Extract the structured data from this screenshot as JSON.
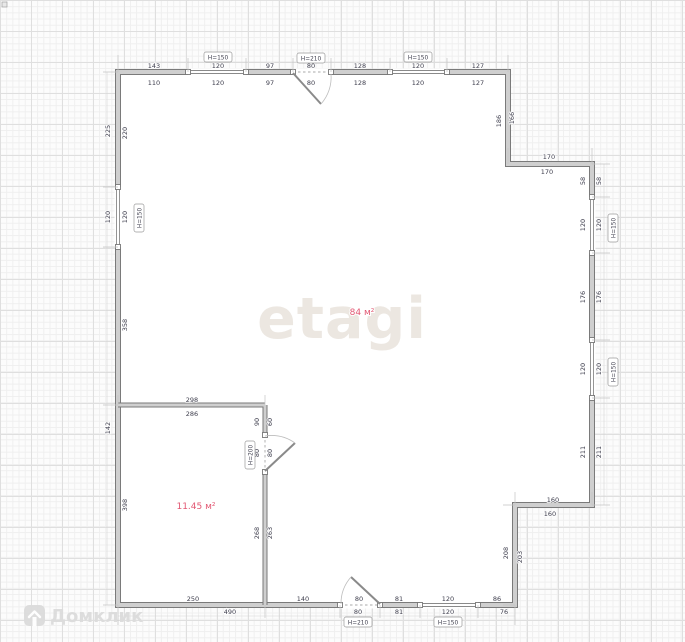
{
  "watermarks": {
    "brand": "etagi",
    "portal": "Домклик"
  },
  "areas": {
    "big_room": "84 м²",
    "small_room": "11.45 м²"
  },
  "heights": {
    "window": "Н=150",
    "entry_door": "Н=210",
    "interior_door": "Н=200"
  },
  "dims": {
    "top_outer": [
      "143",
      "120",
      "97",
      "80",
      "128",
      "120",
      "127"
    ],
    "top_inner": [
      "110",
      "120",
      "97",
      "80",
      "128",
      "120",
      "127"
    ],
    "left_outer": [
      "225",
      "120",
      "142"
    ],
    "left_inner": [
      "220",
      "120",
      "358",
      "398"
    ],
    "step_tr_v": [
      "186",
      "166"
    ],
    "step_tr_h": [
      "170",
      "170"
    ],
    "right_inner": [
      "58",
      "120",
      "176",
      "120",
      "211"
    ],
    "right_outer": [
      "58",
      "120",
      "176",
      "120",
      "211"
    ],
    "step_br_h": [
      "160",
      "160"
    ],
    "step_br_v": [
      "208",
      "203"
    ],
    "bottom_above": [
      "140",
      "80",
      "81",
      "120",
      "86"
    ],
    "bottom_below": [
      "80",
      "81",
      "120",
      "76",
      "490"
    ],
    "small_room_bottom": "250",
    "partition_above": "298",
    "partition_below": "286",
    "partition_v_outer": [
      "90",
      "80",
      "268"
    ],
    "partition_v_inner": [
      "60",
      "80",
      "263"
    ]
  },
  "colors": {
    "area_label": "#e25772",
    "dimension_text": "#3d3d4c",
    "wall_fill": "#cfcfcf",
    "wall_edge": "#7a7a7a",
    "watermark_brand": "#ece7e1",
    "watermark_portal": "#dcdcdc"
  }
}
